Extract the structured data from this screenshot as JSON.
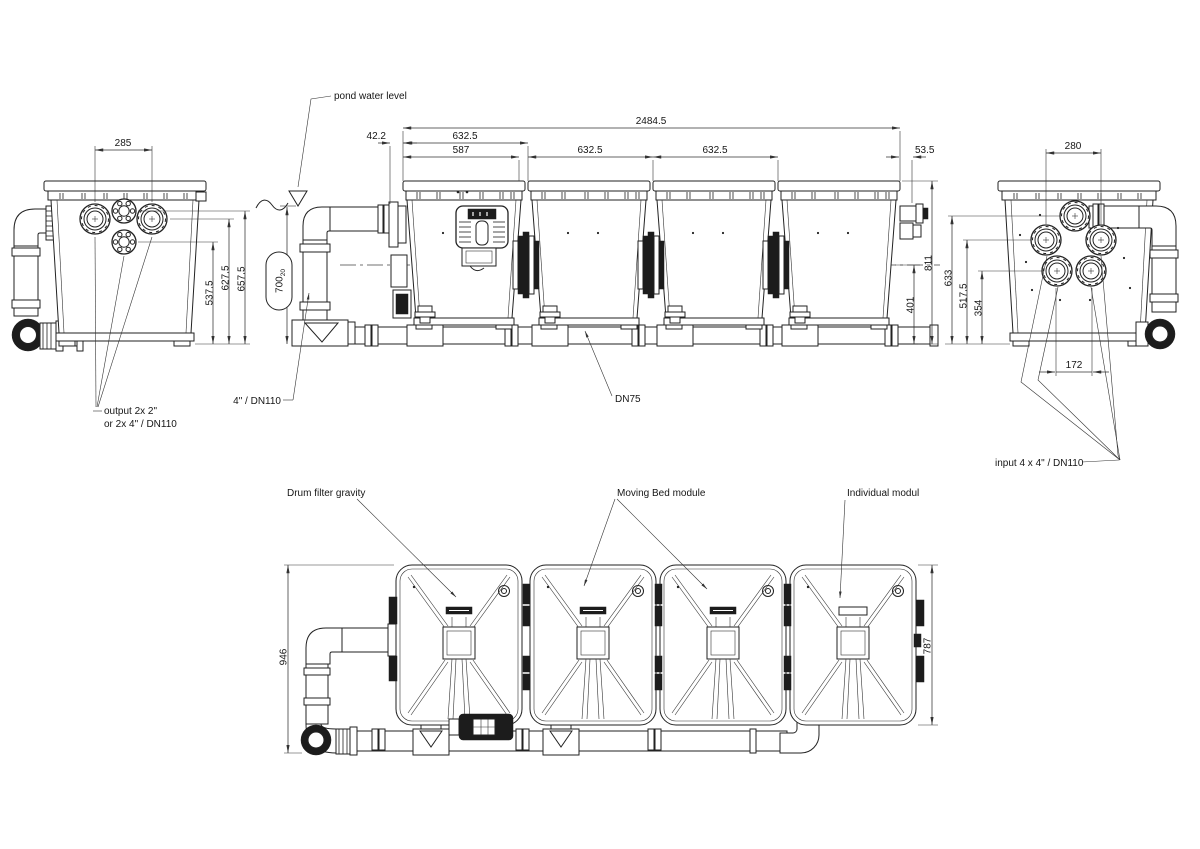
{
  "views": {
    "left_side_view": {
      "dims": {
        "port_spacing": "285",
        "height_low": "537.5",
        "height_mid": "627.5",
        "height_high": "657.5"
      },
      "output_label": {
        "line1": "output 2x 2\"",
        "line2": "or 2x 4\" / DN110"
      }
    },
    "front_view": {
      "pond_water_level_label": "pond water level",
      "dims": {
        "total_width": "2484.5",
        "offset_left": "42.2",
        "module1_width": "632.5",
        "drum_width": "587",
        "module2_width": "632.5",
        "module3_width": "632.5",
        "offset_right": "53.5",
        "water_depth": "700",
        "water_depth_tolerance": "20",
        "total_height": "811",
        "pipe_center_height": "401"
      },
      "pipe_label": "4\" / DN110",
      "drain_pipe_label": "DN75"
    },
    "right_side_view": {
      "dims": {
        "port_spacing_top": "280",
        "height_top_port": "633",
        "height_mid_ports": "517.5",
        "height_bottom_ports": "354",
        "port_spacing_bottom": "172"
      },
      "input_label": "input 4 x 4\" / DN110"
    },
    "top_view": {
      "module_labels": {
        "drum_filter": "Drum filter gravity",
        "moving_bed": "Moving Bed module",
        "individual": "Individual modul"
      },
      "dims": {
        "depth_with_pipes": "946",
        "module_depth": "787"
      }
    }
  }
}
